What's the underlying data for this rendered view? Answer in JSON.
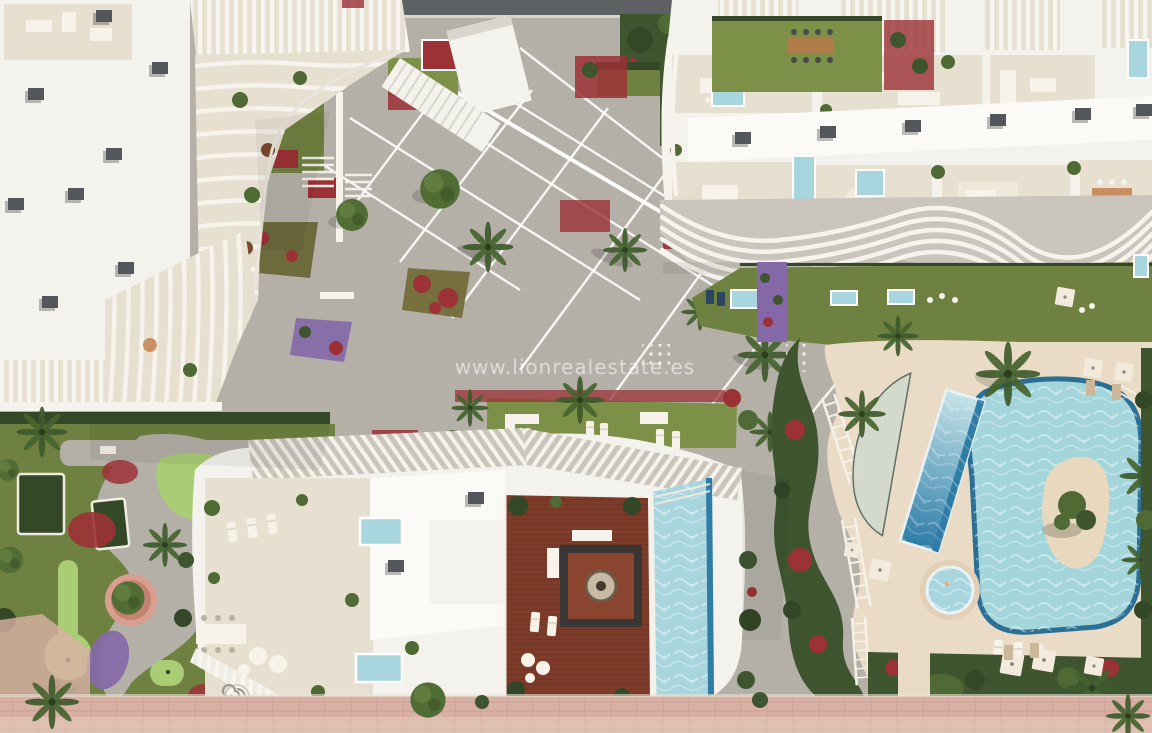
{
  "scene": {
    "type": "aerial-architectural-render",
    "subject": "bird's-eye render of a luxury apartment complex with sculptural white buildings, rooftop terraces, gardens, mini-golf green and lagoon-style pools",
    "watermark": {
      "text": "www.lionrealestate.es"
    }
  },
  "palette": {
    "roadDark": "#5e6164",
    "plazaGray": "#b4b0a7",
    "plazaLight": "#c8c4ba",
    "promenadePink": "#d9b0a4",
    "sandDeck": "#eadbc6",
    "lawnGreen": "#6f8140",
    "lawnLight": "#7d9048",
    "puttingGreen": "#a9cd74",
    "hedgeGreen": "#3f5530",
    "hedgeDark": "#344727",
    "treeGreen": "#4f6a35",
    "flowerRed": "#9c3136",
    "flowerPurple": "#8468a8",
    "roofWhite": "#f4f2ec",
    "roofBright": "#fbfaf6",
    "roofShadow": "#d9d5cd",
    "terraceBeige": "#e7dfd0",
    "finShadow": "#c9c5bc",
    "ventGray": "#53575b",
    "poolLight": "#a9d6de",
    "poolDeep": "#2f7ca6",
    "poolLagoon": "#a3d5db",
    "poolEdge": "#2c6f95",
    "islandSand": "#e8d8bd",
    "woodDeck": "#7d3c2a",
    "woodDark": "#5c2b1e",
    "furnitureWhite": "#f7f3ea",
    "watermark": "rgba(255,255,255,0.55)"
  }
}
